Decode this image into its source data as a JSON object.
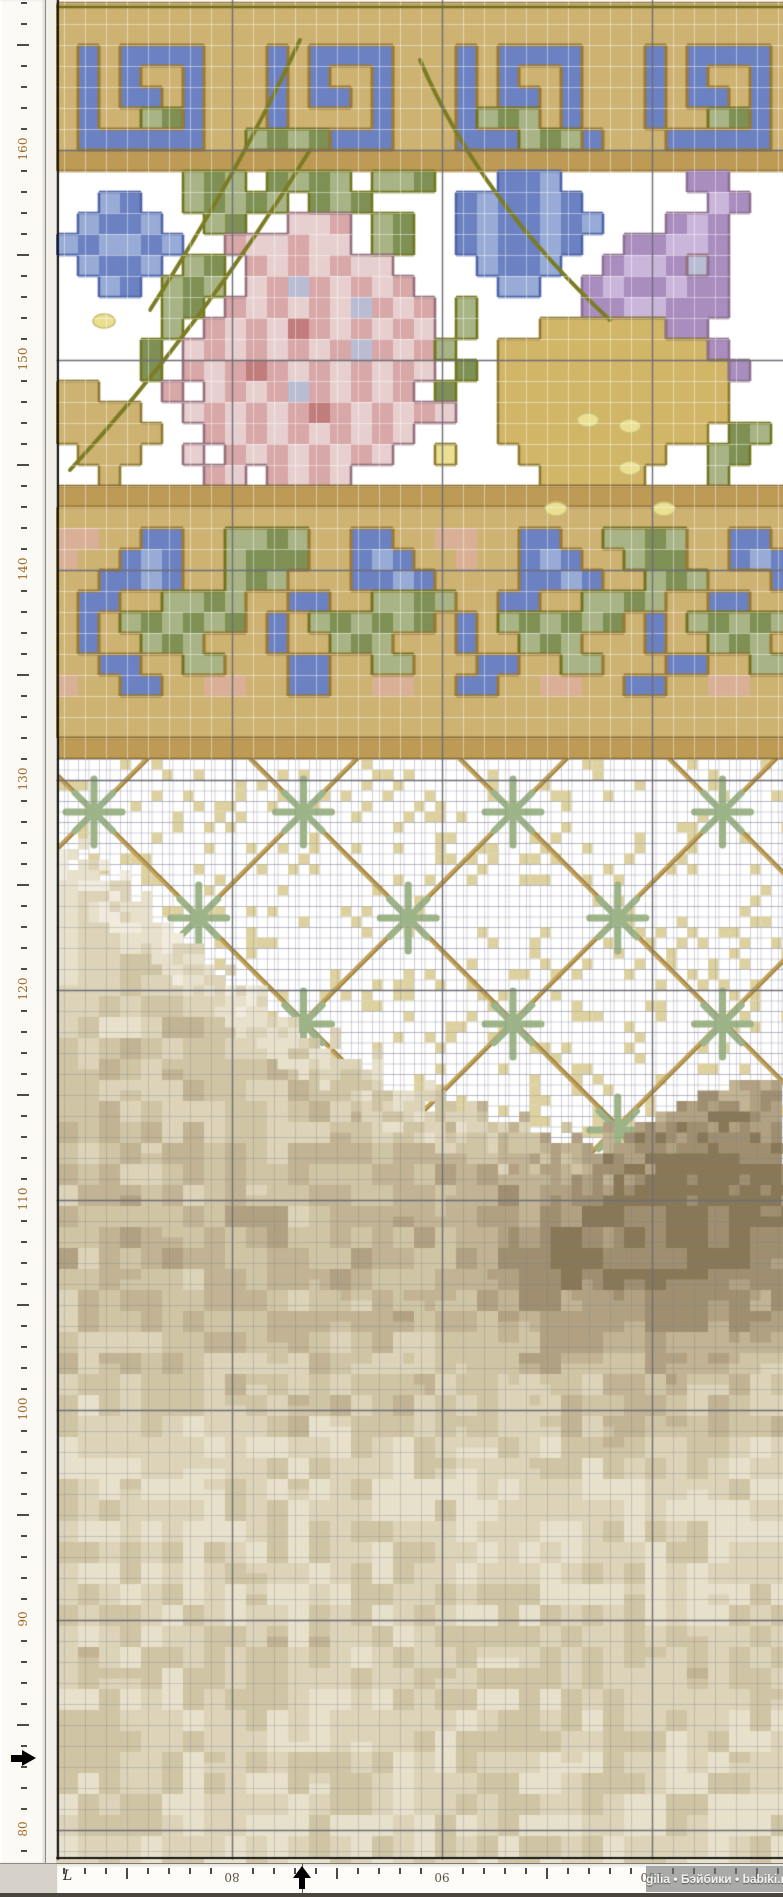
{
  "app": {
    "watermark_text": "gilia • Бэйбики • babiki.ru",
    "origin_label": "L"
  },
  "rulers": {
    "tick_unit_px": 21,
    "left": {
      "orientation": "vertical",
      "labels": [
        {
          "text": "160",
          "y": 150
        },
        {
          "text": "150",
          "y": 360
        },
        {
          "text": "140",
          "y": 570
        },
        {
          "text": "130",
          "y": 780
        },
        {
          "text": "120",
          "y": 990
        },
        {
          "text": "110",
          "y": 1200
        },
        {
          "text": "100",
          "y": 1410
        },
        {
          "text": "90",
          "y": 1620
        },
        {
          "text": "80",
          "y": 1830
        }
      ],
      "arrow_y": 1758
    },
    "bottom": {
      "orientation": "horizontal",
      "labels": [
        {
          "text": "80",
          "x": 232
        },
        {
          "text": "90",
          "x": 442
        },
        {
          "text": "100",
          "x": 652
        }
      ],
      "arrow_x": 302
    }
  },
  "grid": {
    "cell": 21,
    "fine_cell": 10.5,
    "x0": 64,
    "y0": 3,
    "left": 57,
    "top": 0,
    "right": 783,
    "bottom": 1859,
    "major_xs": [
      232,
      442,
      652
    ],
    "major_ys": [
      150,
      360,
      570,
      780,
      990,
      1200,
      1410,
      1620,
      1830
    ],
    "minor_color_on_motif": "rgba(255,255,255,0.45)",
    "minor_color_on_ground": "rgba(122,127,142,0.30)",
    "major_color": "#6e6e76",
    "frame_color": "#141414"
  },
  "palette": {
    ".": "#ffffff",
    "T": "#cdb271",
    "D": "#bd9b55",
    "B": "#6b81c1",
    "b": "#97abd6",
    "G": "#a8b485",
    "g": "#7e9054",
    "P": "#e7cfcf",
    "p": "#d8a7a7",
    "R": "#c17c7c",
    "L": "#b9bdd4",
    "V": "#cab6da",
    "v": "#a98dbf",
    "Y": "#d2b667",
    "C": "#ebdf92",
    "S": "#d9af96"
  },
  "classes": {
    "gold": "TDYCS",
    "blue": "Bb",
    "green": "Gg",
    "pink": "PpRL",
    "purple": "Vv"
  },
  "outline_colors": {
    "border": {
      "gold": "#9b7a35",
      "blue": "#9b7a35",
      "green": "#6f7420",
      "pink": "#96707d",
      "purple": "#8d7191"
    },
    "flowers": {
      "gold": "#8f7a30",
      "blue": "#4f64a8",
      "green": "#71761f",
      "pink": "#96707d",
      "purple": "#8d7191"
    }
  },
  "sections": {
    "border1": {
      "y": 3,
      "style": "border",
      "rows": [
        "TTTTTTTTTTTTTTTTTTTTTTTTTTTTTTTTTTT",
        "TTTTTTTTTTTTTTTTTTTTTTTTTTTTTTTTTTT",
        "TBTBBBBTTTBTBBBBTTTBTBBBBTTTBTBBBBT",
        "TBTBTTBTTTBTBTTBTTTBTBTTBTTTBTBTTBT",
        "TBTBBTBTTTBTBBTBTTTBTBBTBTTTBTBBTBT",
        "TBTTGgBTTTBTTTTBTTTBGgGTBTTTBTTGgBT",
        "TBBBBBBTTGgGgBBBTTTBBBGgGBTTTBBBBBT",
        "DDDDDDDDDDDDDDDDDDDDDDDDDDDDDDDDDDD"
      ]
    },
    "flowers": {
      "y": 171,
      "style": "flowers",
      "rows": [
        "......GgG.gGgG.GGg...BBb......vv...",
        "..bB..GgGgG.gGg....BbBBbB......Vv..",
        ".bBBb..Gg..PPp.Gg..BbBBbBb...vVv...",
        "bBbbBb..pPPpPP.Gg..BbBBbB..vvVVv...",
        ".bBBb.Gg.pPpPpPP....bBBb..vVVvLv...",
        "..bB.GgG.PpLpPpPp....bb..vVvvVvv...",
        ".....Gg.pPpPpPLpPp.G.....vvVVvvv...",
        ".....G.pPpPRpPpPpP.G...YYYYYYvv....",
        "....g.PpPpPpPpLpPpG..YYYYYYYYYYv...",
        "....g.pPpRpPpPpPpP.g.YYYYYYYYYYYv..",
        "TT...p.PpPpLpPpPp.g..YYYYYYYYYYY...",
        "TTTT..PpPpPpRpPpPpP..YYYYYYYYYYY...",
        "TTTTT..pPpPpPpPpP....YYYYYYYYYY.gG.",
        ".TTT..P.pPpPpPpP..C...YYYYYYY..Gg..",
        "..T....pP.pPpP.........YYYYY...G..."
      ]
    },
    "gold_band2": {
      "y": 486
    },
    "border2": {
      "y": 507,
      "style": "border",
      "rows": [
        "TTTTTTTTTTTTTTTTTTTTTTTTTTTTTTTTTTT",
        "SSTTBBTTGGgGTTBBTTSSTTBBTTGGgGTTBBT",
        "STTBbBTTGgggTTBbBTTSTTBbBTTGggTTBbB",
        "TTBBbBTTGgGTTTBBbBTTTTBBbBTTGgGTTTB",
        "TBBTTGGgGTTBBTTGGgGTTBBTTGGgGTTBBTT",
        "TBTGgGgGgTBTGgGgGgTBTGgGgGgTBTGgGgG",
        "TBTTGgGTTTBTTGgGTTTBTTGgGTTTBTTGgGT",
        "TTBBTTGGTTTBBTTGGTTTBBTTGGTTTBBTTGG",
        "STTBBTTSSTTBBTTSSTTBBTTSSTTBBTTSSTT",
        "TTTTTTTTTTTTTTTTTTTTTTTTTTTTTTTTTTT",
        "TTTTTTTTTTTTTTTTTTTTTTTTTTTTTTTTTTT"
      ]
    },
    "gold_band3": {
      "y": 738
    },
    "band_fill": "#bd9b55",
    "band_edge": "#8a6a28",
    "stems": {
      "color": "#7c7c24",
      "width": 4,
      "curves": [
        [
          [
            300,
            40
          ],
          [
            240,
            170
          ],
          [
            150,
            310
          ]
        ],
        [
          [
            310,
            150
          ],
          [
            200,
            330
          ],
          [
            70,
            470
          ]
        ],
        [
          [
            420,
            60
          ],
          [
            480,
            200
          ],
          [
            610,
            320
          ]
        ]
      ]
    },
    "beads": {
      "fill": "#ebdf92",
      "edge": "#c9bd70",
      "positions": [
        [
          104,
          321
        ],
        [
          630,
          426
        ],
        [
          630,
          468
        ],
        [
          556,
          509
        ],
        [
          664,
          509
        ],
        [
          588,
          420
        ]
      ]
    },
    "lattice": {
      "top": 759,
      "bottom": 1170,
      "bg": "#ffffff",
      "dot_color": "#ddd1a0",
      "line_color": "#c2a258",
      "line_edge": "#93763a",
      "star_color": "#9db388",
      "cross_spacing": 209.5,
      "row_spacing": 106,
      "first_cross": [
        94,
        812
      ],
      "rows": [
        812,
        918,
        1024,
        1130
      ]
    },
    "sand": {
      "ramp": [
        "#f0ebdc",
        "#e7e0ca",
        "#dcd3b8",
        "#cfc4a4",
        "#c1b393",
        "#b1a182",
        "#9f8f70",
        "#897857"
      ],
      "top_polyline": [
        [
          57,
          840
        ],
        [
          130,
          885
        ],
        [
          210,
          955
        ],
        [
          290,
          1015
        ],
        [
          370,
          1065
        ],
        [
          460,
          1105
        ],
        [
          560,
          1132
        ],
        [
          660,
          1148
        ],
        [
          783,
          1158
        ]
      ],
      "depth_bands": [
        [
          760,
          1.1
        ],
        [
          880,
          1.6
        ],
        [
          980,
          2.2
        ],
        [
          1080,
          2.8
        ],
        [
          1180,
          3.3
        ],
        [
          1260,
          3.7
        ],
        [
          1340,
          3.1
        ],
        [
          1430,
          2.4
        ],
        [
          1510,
          1.8
        ],
        [
          1580,
          1.9
        ],
        [
          1650,
          2.5
        ],
        [
          1720,
          2.2
        ],
        [
          1800,
          2.0
        ],
        [
          1897,
          1.9
        ]
      ],
      "dune_blobs": [
        {
          "cx": 737,
          "cy": 1180,
          "rx": 120,
          "ry": 90,
          "boost": 3.4
        },
        {
          "cx": 610,
          "cy": 1270,
          "rx": 110,
          "ry": 80,
          "boost": 1.6
        }
      ],
      "dune_spur": [
        [
          783,
          1075
        ],
        [
          758,
          1078
        ],
        [
          700,
          1095
        ],
        [
          640,
          1125
        ],
        [
          600,
          1160
        ],
        [
          620,
          1205
        ],
        [
          783,
          1205
        ]
      ]
    },
    "top_edge_line": {
      "y": 7,
      "color": "#6e6e1e"
    }
  }
}
